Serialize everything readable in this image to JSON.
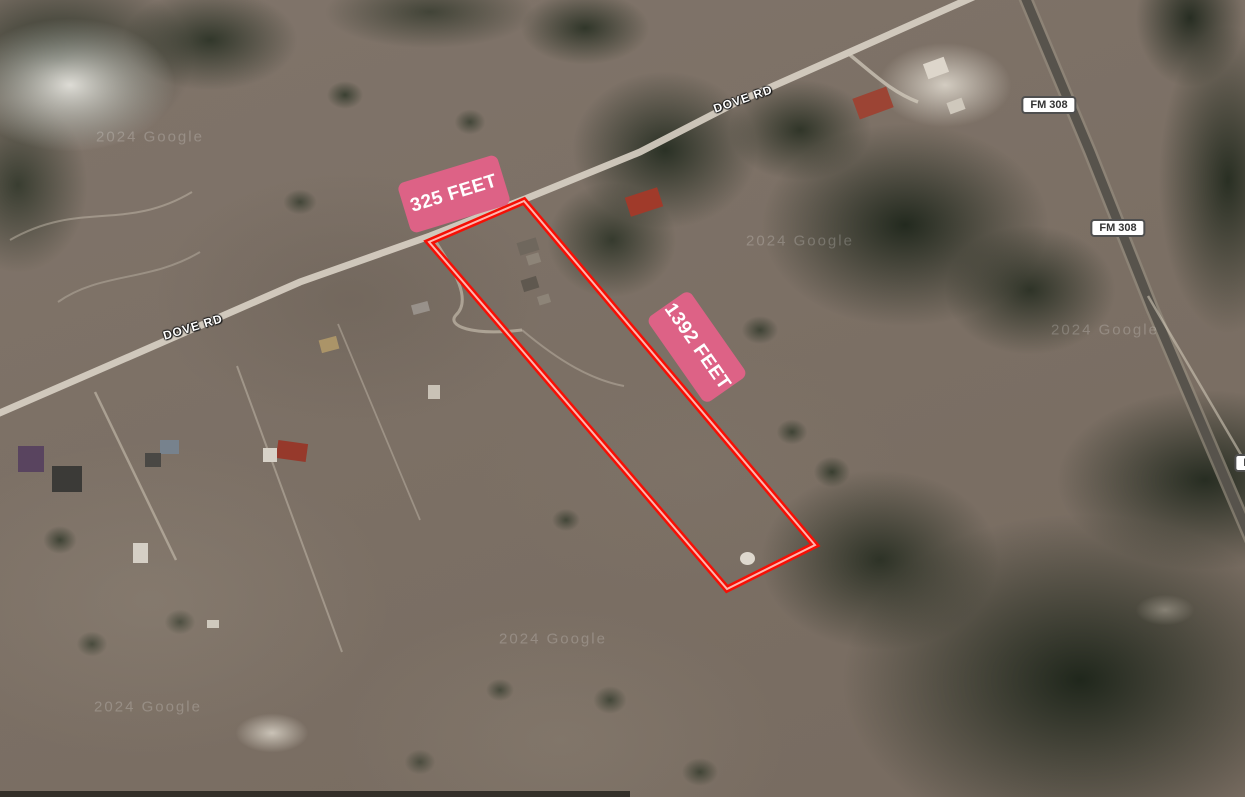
{
  "map": {
    "description": "satellite-aerial-parcel-view",
    "watermark_text": "2024 Google"
  },
  "parcel": {
    "points": "524,201 429,242 727,589 815,545",
    "outline_color": "#f50f05",
    "outline_core_color": "#ffb4ad"
  },
  "measurements": [
    {
      "id": "frontage",
      "text": "325 FEET"
    },
    {
      "id": "depth",
      "text": "1392 FEET"
    }
  ],
  "road_labels": [
    {
      "text": "DOVE RD"
    },
    {
      "text": "DOVE RD"
    }
  ],
  "route_badges": [
    {
      "text": "FM 308"
    },
    {
      "text": "FM 308"
    },
    {
      "text": "FM 308"
    }
  ],
  "watermarks": [
    {
      "text": "2024 Google"
    },
    {
      "text": "2024 Google"
    },
    {
      "text": "2024 Google"
    },
    {
      "text": "2024 Google"
    },
    {
      "text": "2024 Google"
    }
  ],
  "colors": {
    "measurement_bg": "#dd6286",
    "measurement_text": "#ffffff",
    "parcel_outline": "#f50f05",
    "badge_bg": "#ffffff",
    "badge_text": "#333333",
    "road_label_text": "#ffffff"
  }
}
